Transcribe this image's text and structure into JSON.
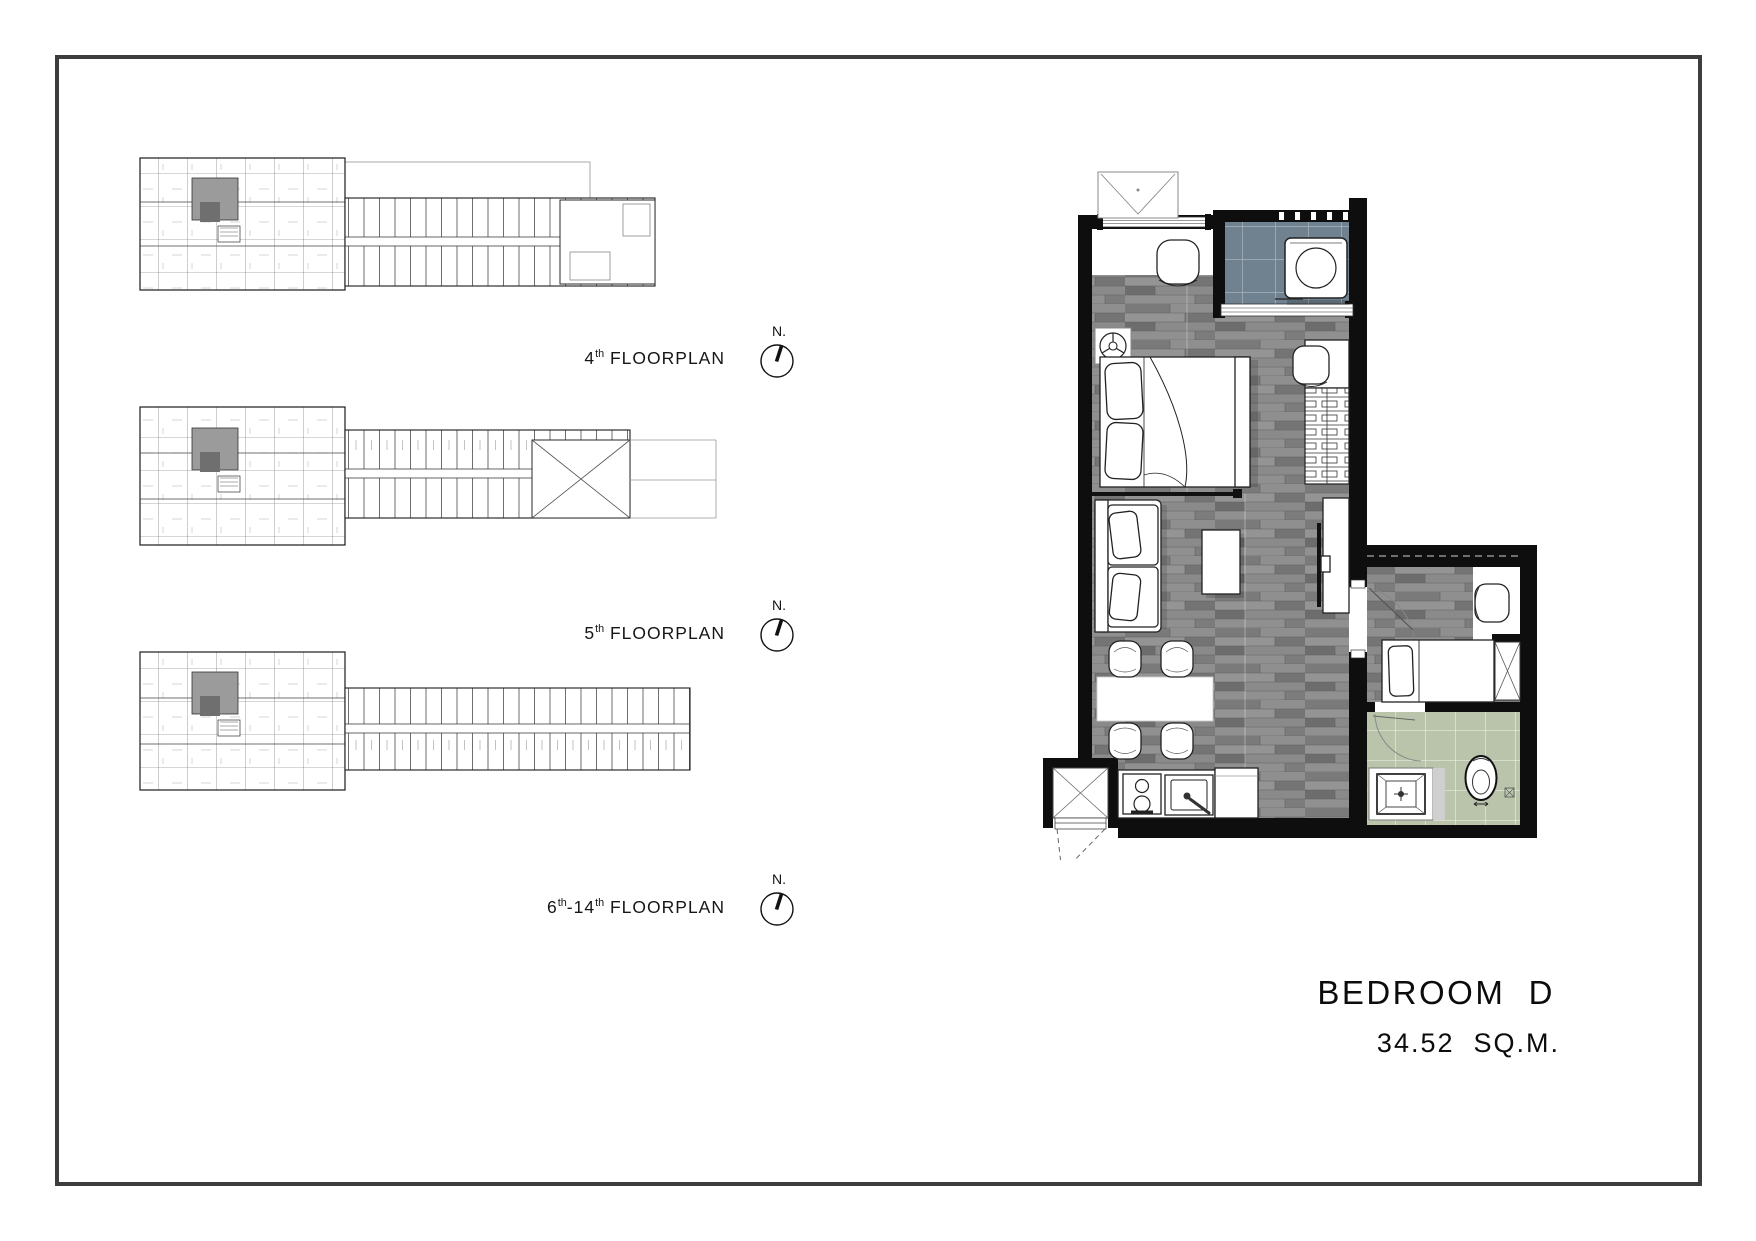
{
  "frame": {
    "border_color": "#3d3d3d"
  },
  "floorplans": [
    {
      "name": "4th-floorplan",
      "label_segments": [
        {
          "t": "4"
        },
        {
          "t": "th",
          "sup": true
        },
        {
          "t": " FLOORPLAN"
        }
      ],
      "compass_label": "N."
    },
    {
      "name": "5th-floorplan",
      "label_segments": [
        {
          "t": "5"
        },
        {
          "t": "th",
          "sup": true
        },
        {
          "t": " FLOORPLAN"
        }
      ],
      "compass_label": "N."
    },
    {
      "name": "6th-14th-floorplan",
      "label_segments": [
        {
          "t": "6"
        },
        {
          "t": "th",
          "sup": true
        },
        {
          "t": "-14"
        },
        {
          "t": "th",
          "sup": true
        },
        {
          "t": " FLOORPLAN"
        }
      ],
      "compass_label": "N."
    }
  ],
  "unit": {
    "title": "BEDROOM  D",
    "area": "34.52  SQ.M."
  },
  "colors": {
    "frame": "#3d3d3d",
    "wall": "#0e0e0e",
    "wood_floor": "#868686",
    "balcony_tile": "#70818f",
    "bathroom_tile": "#b9c4ab",
    "highlighted_unit": "#9b9b9b"
  }
}
